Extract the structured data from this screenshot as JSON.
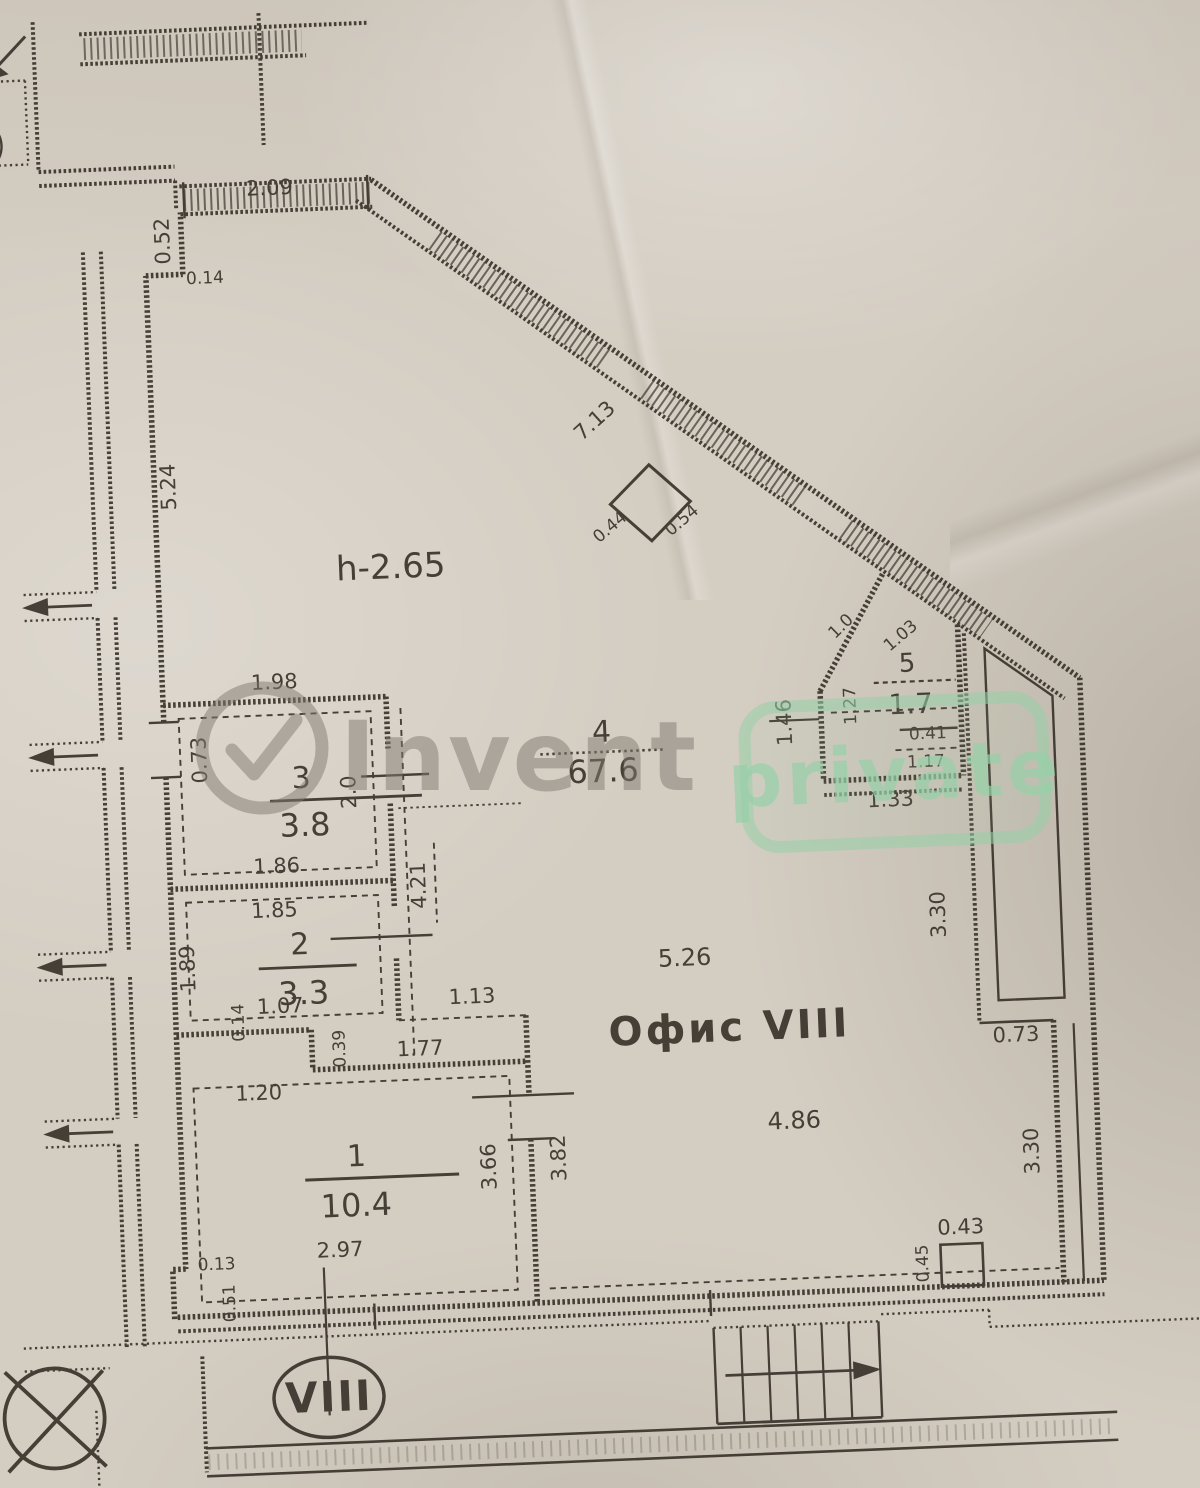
{
  "title": {
    "office": "Офис VIII",
    "height": "h-2.65",
    "unit": "VIII"
  },
  "rooms": {
    "r1": {
      "num": "1",
      "area": "10.4"
    },
    "r2": {
      "num": "2",
      "area": "3.3"
    },
    "r3": {
      "num": "3",
      "area": "3.8"
    },
    "r4": {
      "num": "4",
      "area": "67.6"
    },
    "r5": {
      "num": "5",
      "area": "1.7"
    }
  },
  "dims": {
    "d209": "2.09",
    "d052": "0.52",
    "d014": "0.14",
    "d524": "5.24",
    "d713": "7.13",
    "d044": "0.44",
    "d054": "0.54",
    "d198": "1.98",
    "d073a": "0.73",
    "d186": "1.86",
    "d20": "2.0",
    "d421": "4.21",
    "d185": "1.85",
    "d189": "1.89",
    "d107": "1.07",
    "d014b": "0.14",
    "d113": "1.13",
    "d039": "0.39",
    "d177": "1.77",
    "d120": "1.20",
    "d297": "2.97",
    "d366": "3.66",
    "d382": "3.82",
    "d526": "5.26",
    "d486": "4.86",
    "d10": "1.0",
    "d103": "1.03",
    "d127": "1.27",
    "d146": "1.46",
    "d041": "0.41",
    "d117": "1.17",
    "d133": "1.33",
    "d330a": "3.30",
    "d073b": "0.73",
    "d330b": "3.30",
    "d045": "0.45",
    "d043": "0.43",
    "d013": "0.13",
    "d051": "0.51"
  },
  "watermark": {
    "brand": "Invent",
    "badge": "private"
  },
  "colors": {
    "ink": "#3a332b",
    "paper": "#d4cdc2",
    "watermark_gray": "#807a70",
    "watermark_green": "#96d0a8"
  }
}
